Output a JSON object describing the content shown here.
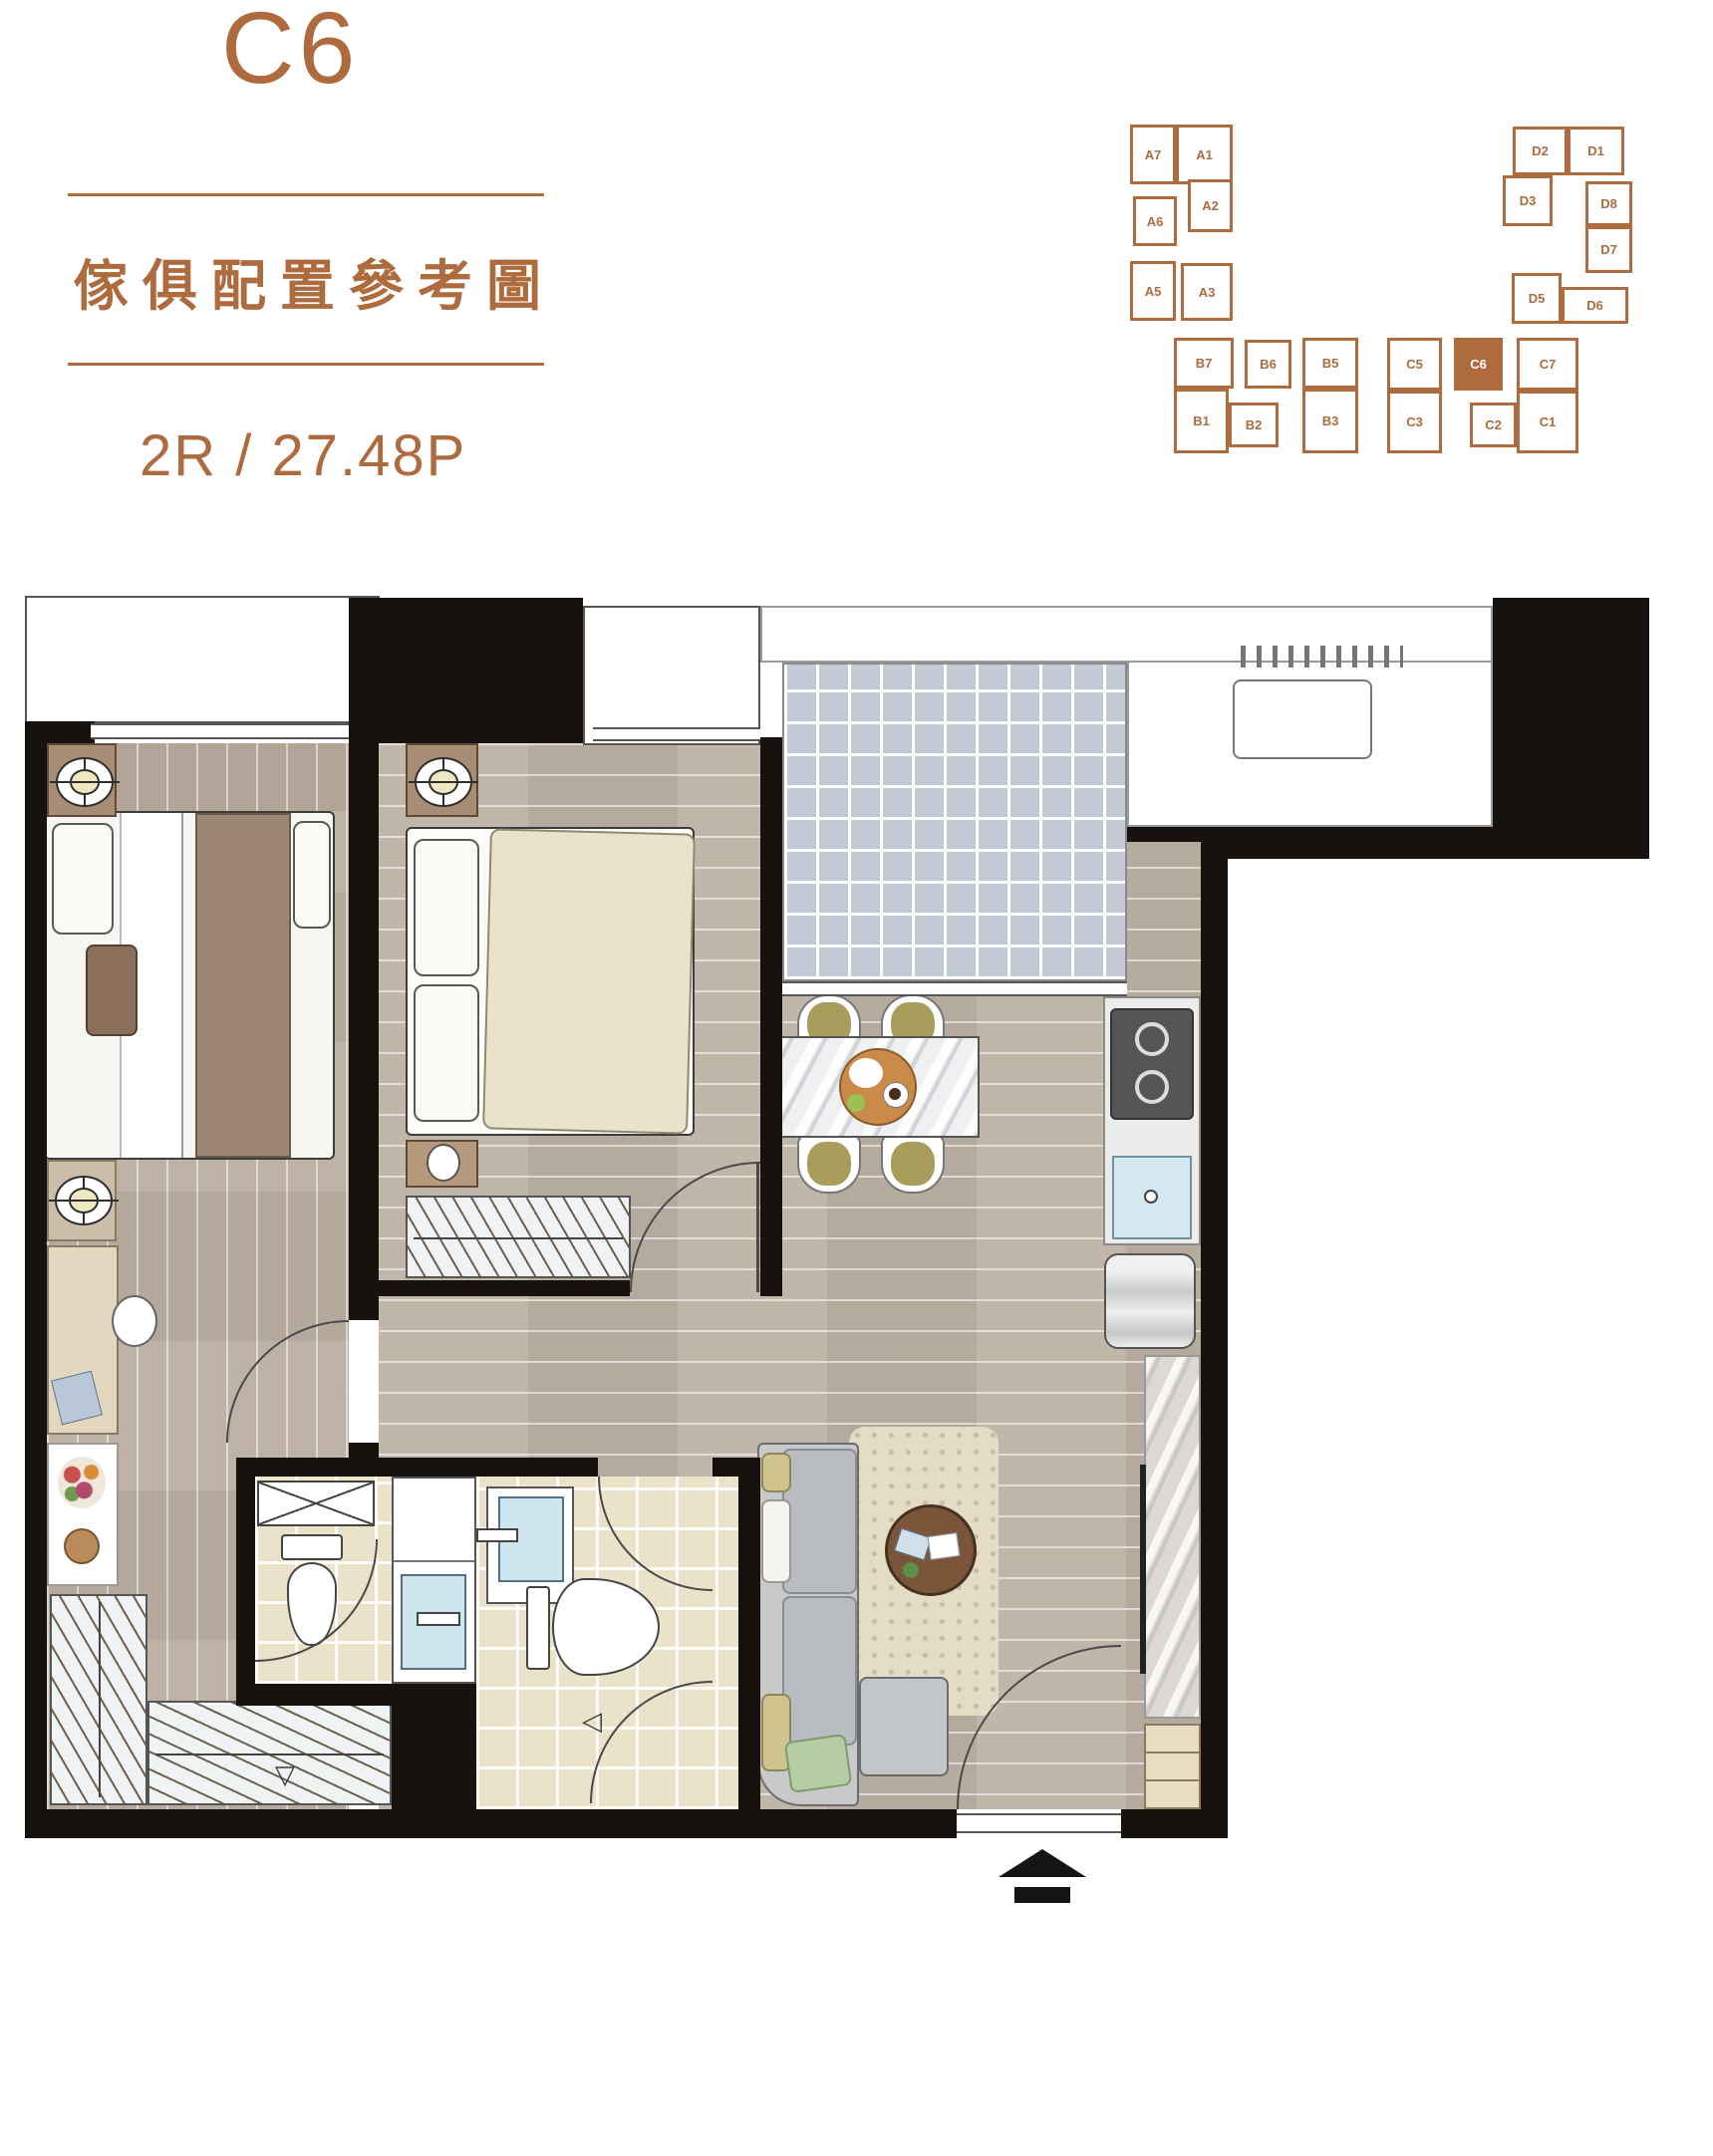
{
  "page": {
    "title_unit": "C6",
    "subtitle": "傢俱配置參考圖",
    "spec": "2R / 27.48P"
  },
  "keyplan": {
    "highlighted_unit": "C6",
    "blocks": {
      "a": {
        "units": [
          "A7",
          "A1",
          "A6",
          "A2",
          "A5",
          "A3"
        ]
      },
      "b": {
        "units": [
          "B7",
          "B6",
          "B5",
          "B1",
          "B2",
          "B3"
        ]
      },
      "c": {
        "units": [
          "C5",
          "C6",
          "C7",
          "C3",
          "C2",
          "C1"
        ]
      },
      "d": {
        "units": [
          "D2",
          "D1",
          "D3",
          "D8",
          "D7",
          "D5",
          "D6"
        ]
      }
    }
  },
  "markers": {
    "shower_door_left": "◁",
    "floor_drain_down": "▽"
  },
  "colors": {
    "brand_brown": "#AD6B3E",
    "wall_black": "#17120E",
    "wood_floor": "#C9BFB4",
    "balcony_tile": "#C4CAD5",
    "bath_tile": "#EAE2C9",
    "sofa_grey": "#C7C9CB",
    "rug_beige": "#E5DCC6",
    "bed2_duvet": "#E9E3CB",
    "throw_brown": "#9C8674",
    "accent_olive": "#CFC490",
    "accent_green": "#B5CDA5",
    "sink_blue": "#CFE6EE",
    "table_wood": "#7B553A"
  }
}
